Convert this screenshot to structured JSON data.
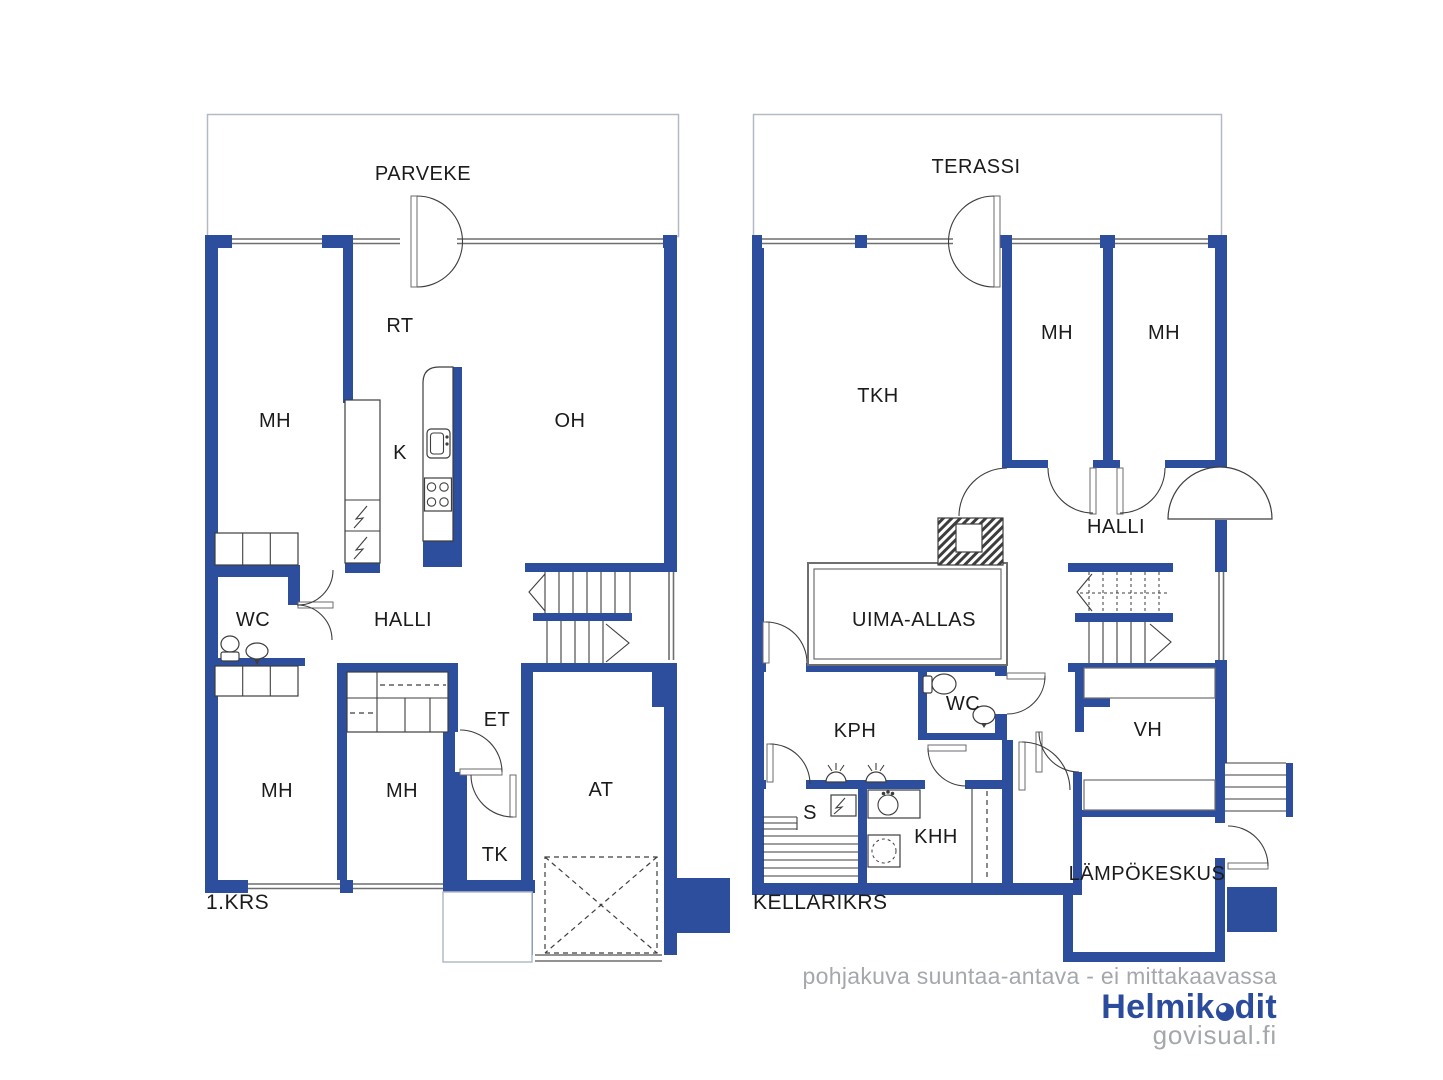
{
  "left_plan": {
    "floor_label": "1.KRS",
    "outdoor_label": "PARVEKE",
    "rooms": [
      {
        "id": "mh-upper",
        "label": "MH"
      },
      {
        "id": "rt",
        "label": "RT"
      },
      {
        "id": "k",
        "label": "K"
      },
      {
        "id": "oh",
        "label": "OH"
      },
      {
        "id": "wc",
        "label": "WC"
      },
      {
        "id": "halli",
        "label": "HALLI"
      },
      {
        "id": "et",
        "label": "ET"
      },
      {
        "id": "mh-lower-left",
        "label": "MH"
      },
      {
        "id": "mh-lower-mid",
        "label": "MH"
      },
      {
        "id": "tk",
        "label": "TK"
      },
      {
        "id": "at",
        "label": "AT"
      }
    ]
  },
  "right_plan": {
    "floor_label": "KELLARIKRS",
    "outdoor_label": "TERASSI",
    "rooms": [
      {
        "id": "tkh",
        "label": "TKH"
      },
      {
        "id": "mh-1",
        "label": "MH"
      },
      {
        "id": "mh-2",
        "label": "MH"
      },
      {
        "id": "halli",
        "label": "HALLI"
      },
      {
        "id": "uima-allas",
        "label": "UIMA-ALLAS"
      },
      {
        "id": "wc",
        "label": "WC"
      },
      {
        "id": "kph",
        "label": "KPH"
      },
      {
        "id": "s",
        "label": "S"
      },
      {
        "id": "khh",
        "label": "KHH"
      },
      {
        "id": "vh",
        "label": "VH"
      },
      {
        "id": "lampokeskus",
        "label": "LÄMPÖKESKUS"
      }
    ]
  },
  "footer": {
    "disclaimer": "pohjakuva suuntaa-antava - ei mittakaavassa",
    "brand_full": "Helmikodit",
    "brand_part1": "Helmik",
    "brand_part2": "dit",
    "website": "govisual.fi"
  },
  "colors": {
    "wall": "#2c4e9d",
    "brand": "#2b4c9c",
    "muted": "#a4a8ad"
  }
}
